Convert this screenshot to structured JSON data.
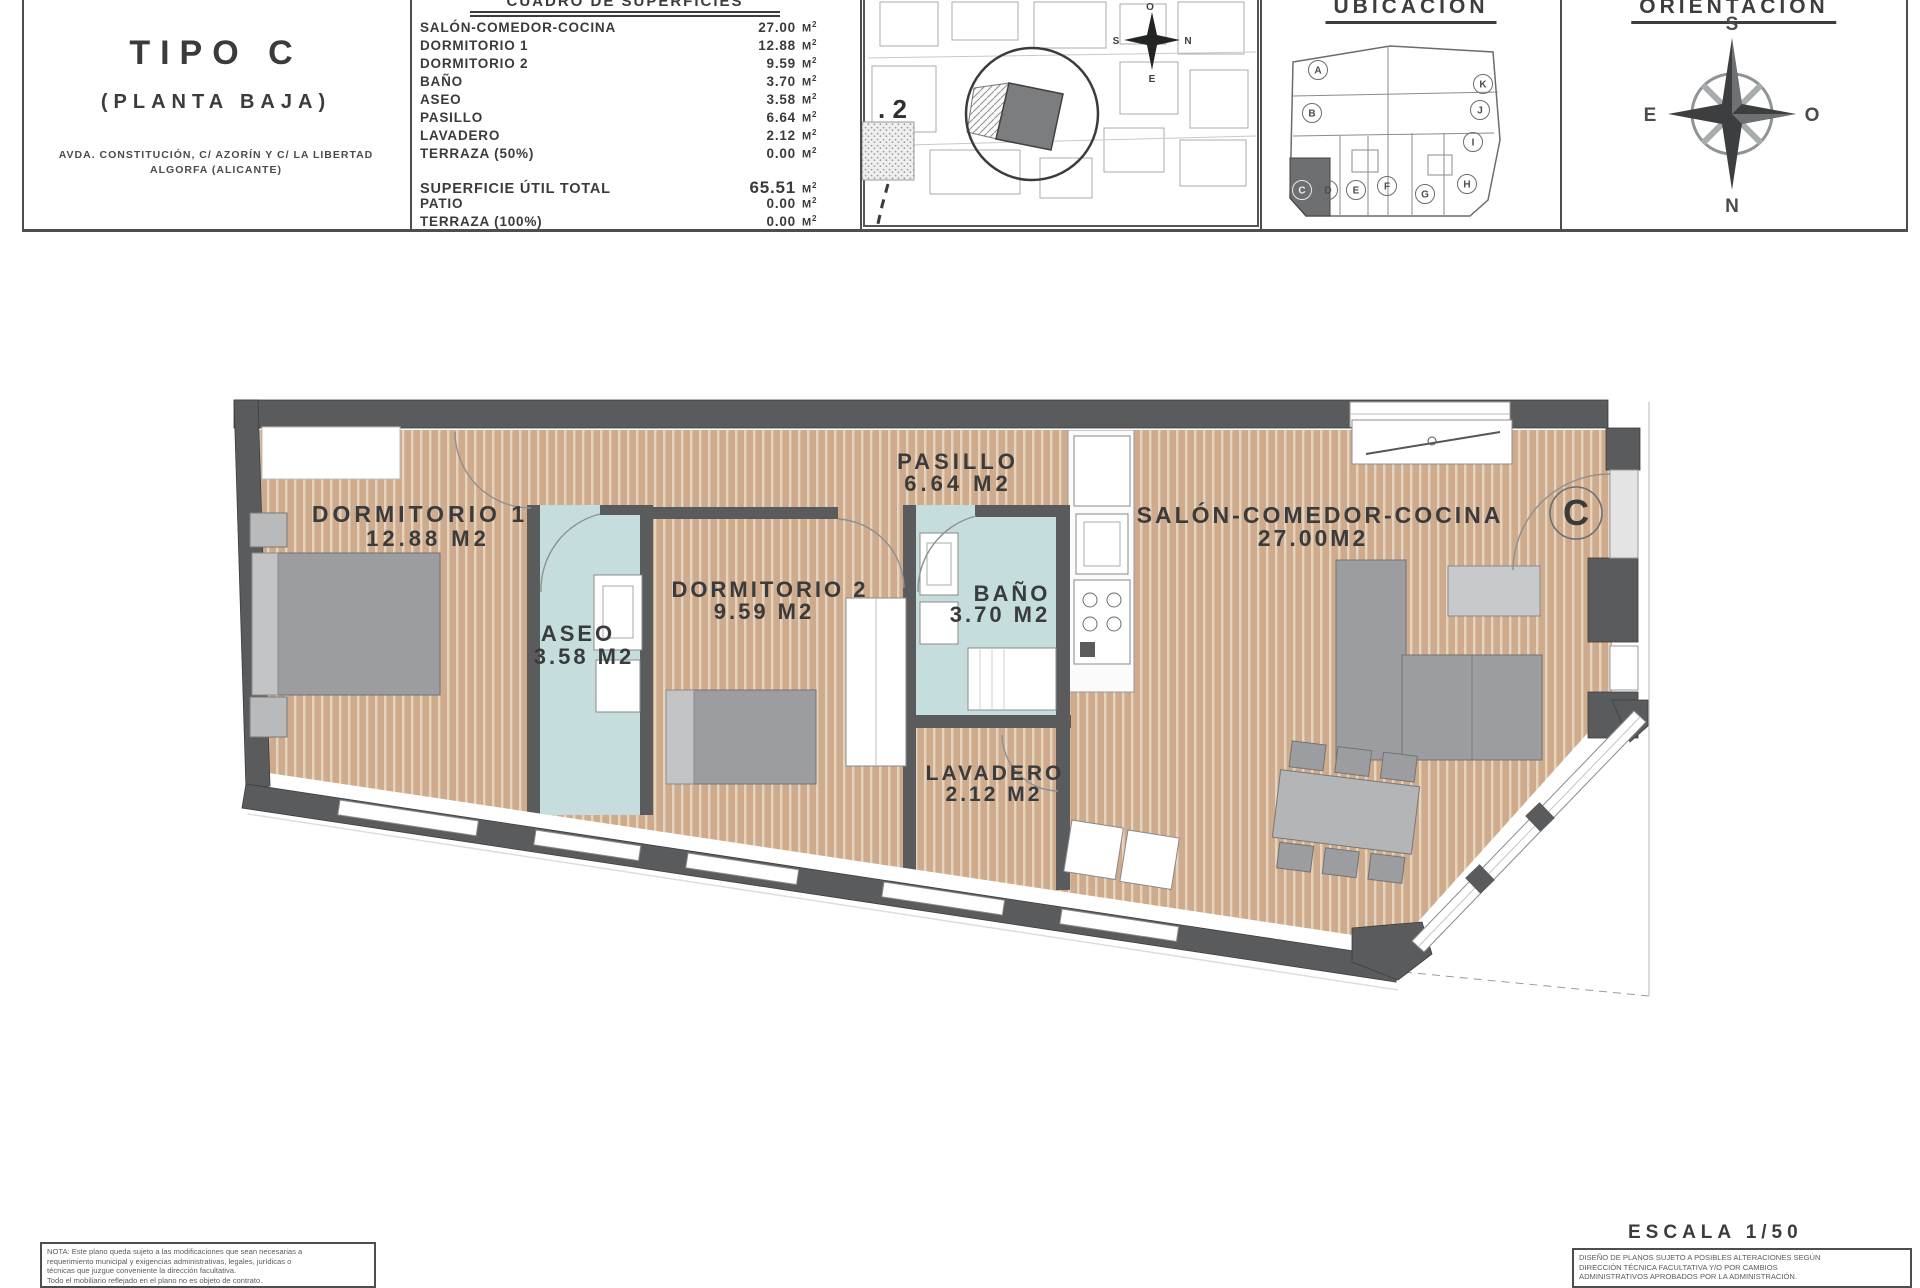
{
  "title_block": {
    "title": "TIPO C",
    "subtitle": "(PLANTA BAJA)",
    "address_line1": "AVDA. CONSTITUCIÓN, C/ AZORÍN Y C/ LA LIBERTAD",
    "address_line2": "ALGORFA (ALICANTE)"
  },
  "surface_table": {
    "title": "CUADRO DE SUPERFICIES",
    "unit_base": "M",
    "unit_sup": "2",
    "rows": [
      {
        "label": "SALÓN-COMEDOR-COCINA",
        "value": "27.00"
      },
      {
        "label": "DORMITORIO 1",
        "value": "12.88"
      },
      {
        "label": "DORMITORIO 2",
        "value": "9.59"
      },
      {
        "label": "BAÑO",
        "value": "3.70"
      },
      {
        "label": "ASEO",
        "value": "3.58"
      },
      {
        "label": "PASILLO",
        "value": "6.64"
      },
      {
        "label": "LAVADERO",
        "value": "2.12"
      },
      {
        "label": "TERRAZA (50%)",
        "value": "0.00"
      }
    ],
    "totals": [
      {
        "label": "SUPERFICIE ÚTIL TOTAL",
        "value": "65.51"
      },
      {
        "label": "PATIO",
        "value": "0.00"
      },
      {
        "label": "TERRAZA (100%)",
        "value": "0.00"
      }
    ]
  },
  "site_plan": {
    "plot_label": ". 2",
    "compass": {
      "top": "O",
      "left": "S",
      "right": "N",
      "bottom": "E"
    }
  },
  "ubicacion": {
    "title": "UBICACIÓN",
    "units": [
      "A",
      "K",
      "B",
      "J",
      "I",
      "C",
      "D",
      "E",
      "F",
      "G",
      "H"
    ]
  },
  "orientacion": {
    "title": "ORIENTACIÓN",
    "compass": {
      "top": "S",
      "bottom": "N",
      "left": "E",
      "right": "O"
    }
  },
  "plan": {
    "unit_mark": "C",
    "rooms": [
      {
        "name": "DORMITORIO 1",
        "area": "12.88 M2"
      },
      {
        "name": "ASEO",
        "area": "3.58 M2"
      },
      {
        "name": "DORMITORIO 2",
        "area": "9.59 M2"
      },
      {
        "name": "PASILLO",
        "area": "6.64 M2"
      },
      {
        "name": "BAÑO",
        "area": "3.70 M2"
      },
      {
        "name": "LAVADERO",
        "area": "2.12 M2"
      },
      {
        "name": "SALÓN-COMEDOR-COCINA",
        "area": "27.00M2"
      }
    ]
  },
  "footer": {
    "scale": "ESCALA 1/50",
    "note_left_lines": [
      "NOTA: Este plano queda sujeto a las modificaciones que sean necesarias a",
      "requerimiento municipal y exigencias administrativas, legales, jurídicas o",
      "técnicas que juzgue conveniente la dirección facultativa.",
      "Todo el mobiliario reflejado en el plano no es objeto de contrato."
    ],
    "note_right_lines": [
      "DISEÑO DE PLANOS SUJETO A POSIBLES ALTERACIONES SEGÚN",
      "DIRECCIÓN TÉCNICA FACULTATIVA Y/O POR CAMBIOS",
      "ADMINISTRATIVOS APROBADOS POR LA ADMINISTRACIÓN."
    ]
  },
  "colors": {
    "wood_floor": "#cdab8c",
    "wet_floor": "#c5dedd",
    "wall": "#5a5b5d",
    "furniture": "#9c9da0"
  }
}
